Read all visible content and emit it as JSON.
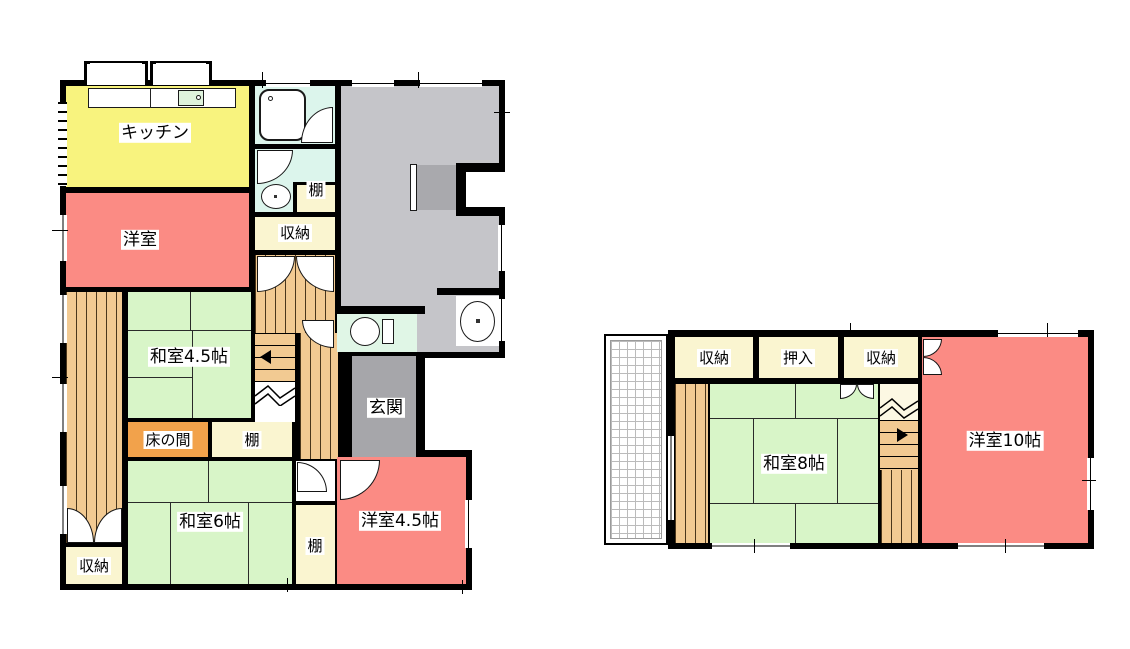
{
  "floor1": {
    "labels": {
      "kitchen": "キッチン",
      "western_room": "洋室",
      "japanese_room_45": "和室4.5帖",
      "tokonoma": "床の間",
      "shelf_middle": "棚",
      "japanese_room_6": "和室6帖",
      "closet_bottom_left": "収納",
      "shelf_bottom": "棚",
      "western_room_45": "洋室4.5帖",
      "entrance": "玄関",
      "shelf_top": "棚",
      "closet_top": "収納"
    }
  },
  "floor2": {
    "labels": {
      "closet_left": "収納",
      "oshiire": "押入",
      "closet_right": "収納",
      "japanese_room_8": "和室8帖",
      "western_room_10": "洋室10帖"
    }
  },
  "colors": {
    "wall": "#000000",
    "kitchen": "#F8F37E",
    "western_room": "#FB8B84",
    "tatami": "#D8F5C8",
    "closet": "#FAF5D0",
    "wood_floor": "#F2CA92",
    "tokonoma": "#F2A24B",
    "living_gray": "#C5C5C9",
    "entrance_gray": "#A6A6AA",
    "bathroom": "#DCF5EC"
  }
}
